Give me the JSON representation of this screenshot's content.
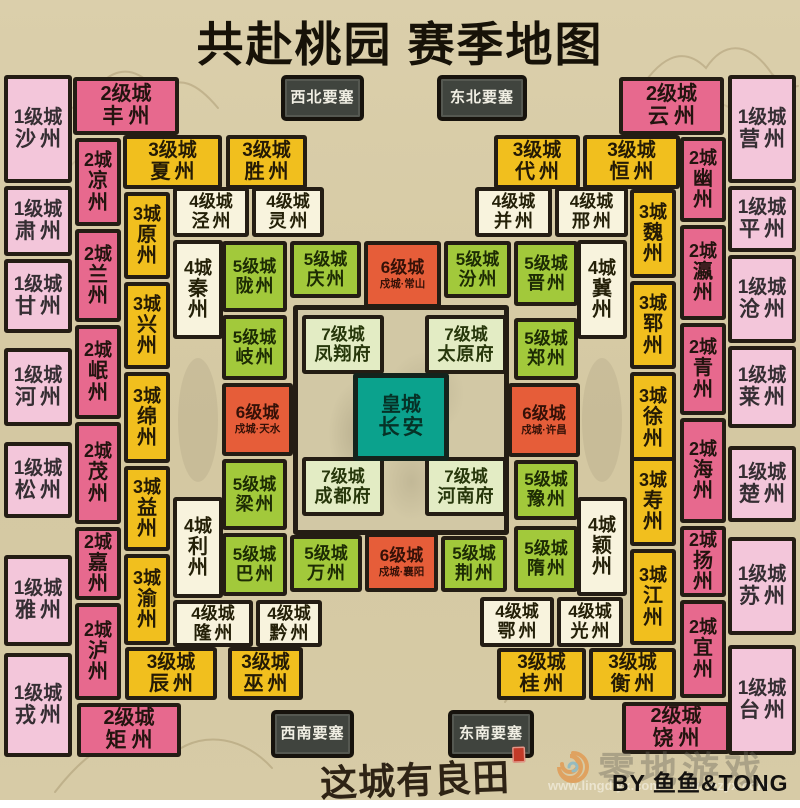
{
  "title": "共赴桃园 赛季地图",
  "logo": "这城有良田",
  "credit": "BY 鱼鱼&TONG",
  "watermark": {
    "brand": "零地游戏",
    "url1": "www.lingdiyx.com",
    "url2": "w.oezyx.com"
  },
  "palette": {
    "lv1": {
      "bg": "#f3c6da",
      "fg": "#352e33"
    },
    "lv2": {
      "bg": "#e7698e",
      "fg": "#23140f"
    },
    "lv3": {
      "bg": "#f1bf1e",
      "fg": "#241a05"
    },
    "lv4": {
      "bg": "#f8f3dd",
      "fg": "#242008"
    },
    "lv5": {
      "bg": "#a2c93b",
      "fg": "#1d2b04"
    },
    "lv6": {
      "bg": "#e65d39",
      "fg": "#351107"
    },
    "lv7": {
      "bg": "#e3ecc4",
      "fg": "#27370b"
    },
    "royal": {
      "bg": "#0ba28d",
      "fg": "#063227"
    },
    "fort": {
      "bg": "#40443e",
      "fg": "#f1efe4"
    }
  },
  "fortresses": [
    {
      "name": "西北要塞",
      "x": 281,
      "y": 75,
      "w": 83,
      "h": 46
    },
    {
      "name": "东北要塞",
      "x": 437,
      "y": 75,
      "w": 90,
      "h": 46
    },
    {
      "name": "西南要塞",
      "x": 271,
      "y": 710,
      "w": 83,
      "h": 48
    },
    {
      "name": "东南要塞",
      "x": 448,
      "y": 710,
      "w": 86,
      "h": 48
    }
  ],
  "center": {
    "box": {
      "x": 293,
      "y": 305,
      "w": 216,
      "h": 230
    },
    "palaces": [
      {
        "label": "7级城",
        "name": "凤翔府",
        "x": 302,
        "y": 315,
        "w": 82,
        "h": 59
      },
      {
        "label": "7级城",
        "name": "太原府",
        "x": 425,
        "y": 315,
        "w": 82,
        "h": 59
      },
      {
        "label": "7级城",
        "name": "成都府",
        "x": 302,
        "y": 457,
        "w": 82,
        "h": 59
      },
      {
        "label": "7级城",
        "name": "河南府",
        "x": 425,
        "y": 457,
        "w": 82,
        "h": 59
      }
    ],
    "imperial": {
      "label": "皇城",
      "name": "长安",
      "x": 353,
      "y": 373,
      "w": 96,
      "h": 88
    }
  },
  "tiles": [
    {
      "lv": "lv1",
      "label": "1级城",
      "name": "沙州",
      "o": "h",
      "x": 4,
      "y": 75,
      "w": 68,
      "h": 108
    },
    {
      "lv": "lv1",
      "label": "1级城",
      "name": "肃州",
      "o": "h",
      "x": 4,
      "y": 186,
      "w": 68,
      "h": 70
    },
    {
      "lv": "lv1",
      "label": "1级城",
      "name": "甘州",
      "o": "h",
      "x": 4,
      "y": 259,
      "w": 68,
      "h": 74
    },
    {
      "lv": "lv1",
      "label": "1级城",
      "name": "河州",
      "o": "h",
      "x": 4,
      "y": 348,
      "w": 68,
      "h": 78
    },
    {
      "lv": "lv1",
      "label": "1级城",
      "name": "松州",
      "o": "h",
      "x": 4,
      "y": 442,
      "w": 68,
      "h": 76
    },
    {
      "lv": "lv1",
      "label": "1级城",
      "name": "雅州",
      "o": "h",
      "x": 4,
      "y": 555,
      "w": 68,
      "h": 91
    },
    {
      "lv": "lv1",
      "label": "1级城",
      "name": "戎州",
      "o": "h",
      "x": 4,
      "y": 653,
      "w": 68,
      "h": 104
    },
    {
      "lv": "lv2",
      "label": "2级城",
      "name": "丰州",
      "o": "h",
      "x": 73,
      "y": 77,
      "w": 106,
      "h": 58
    },
    {
      "lv": "lv2",
      "label": "2城",
      "name": "凉州",
      "o": "v",
      "x": 75,
      "y": 138,
      "w": 46,
      "h": 88
    },
    {
      "lv": "lv2",
      "label": "2城",
      "name": "兰州",
      "o": "v",
      "x": 75,
      "y": 229,
      "w": 46,
      "h": 93
    },
    {
      "lv": "lv2",
      "label": "2城",
      "name": "岷州",
      "o": "v",
      "x": 75,
      "y": 325,
      "w": 46,
      "h": 94
    },
    {
      "lv": "lv2",
      "label": "2城",
      "name": "茂州",
      "o": "v",
      "x": 75,
      "y": 422,
      "w": 46,
      "h": 102
    },
    {
      "lv": "lv2",
      "label": "2城",
      "name": "嘉州",
      "o": "v",
      "x": 75,
      "y": 527,
      "w": 46,
      "h": 73
    },
    {
      "lv": "lv2",
      "label": "2城",
      "name": "泸州",
      "o": "v",
      "x": 75,
      "y": 603,
      "w": 46,
      "h": 97
    },
    {
      "lv": "lv2",
      "label": "2级城",
      "name": "矩州",
      "o": "h",
      "x": 77,
      "y": 703,
      "w": 104,
      "h": 54
    },
    {
      "lv": "lv3",
      "label": "3级城",
      "name": "夏州",
      "o": "h",
      "x": 123,
      "y": 135,
      "w": 99,
      "h": 54
    },
    {
      "lv": "lv3",
      "label": "3级城",
      "name": "胜州",
      "o": "h",
      "x": 226,
      "y": 135,
      "w": 81,
      "h": 54
    },
    {
      "lv": "lv3",
      "label": "3城",
      "name": "原州",
      "o": "v",
      "x": 124,
      "y": 192,
      "w": 46,
      "h": 87
    },
    {
      "lv": "lv3",
      "label": "3城",
      "name": "兴州",
      "o": "v",
      "x": 124,
      "y": 282,
      "w": 46,
      "h": 87
    },
    {
      "lv": "lv3",
      "label": "3城",
      "name": "绵州",
      "o": "v",
      "x": 124,
      "y": 372,
      "w": 46,
      "h": 91
    },
    {
      "lv": "lv3",
      "label": "3城",
      "name": "益州",
      "o": "v",
      "x": 124,
      "y": 466,
      "w": 46,
      "h": 85
    },
    {
      "lv": "lv3",
      "label": "3城",
      "name": "渝州",
      "o": "v",
      "x": 124,
      "y": 554,
      "w": 46,
      "h": 91
    },
    {
      "lv": "lv3",
      "label": "3级城",
      "name": "辰州",
      "o": "h",
      "x": 125,
      "y": 647,
      "w": 92,
      "h": 53
    },
    {
      "lv": "lv3",
      "label": "3级城",
      "name": "巫州",
      "o": "h",
      "x": 228,
      "y": 647,
      "w": 75,
      "h": 53
    },
    {
      "lv": "lv4",
      "label": "4级城",
      "name": "泾州",
      "o": "h",
      "x": 173,
      "y": 187,
      "w": 76,
      "h": 50
    },
    {
      "lv": "lv4",
      "label": "4级城",
      "name": "灵州",
      "o": "h",
      "x": 252,
      "y": 187,
      "w": 72,
      "h": 50
    },
    {
      "lv": "lv4",
      "label": "4城",
      "name": "秦州",
      "o": "v",
      "x": 173,
      "y": 240,
      "w": 50,
      "h": 99
    },
    {
      "lv": "lv4",
      "label": "4城",
      "name": "利州",
      "o": "v",
      "x": 173,
      "y": 497,
      "w": 50,
      "h": 101
    },
    {
      "lv": "lv4",
      "label": "4级城",
      "name": "隆州",
      "o": "h",
      "x": 173,
      "y": 600,
      "w": 80,
      "h": 47
    },
    {
      "lv": "lv4",
      "label": "4级城",
      "name": "黔州",
      "o": "h",
      "x": 256,
      "y": 600,
      "w": 66,
      "h": 47
    },
    {
      "lv": "lv5",
      "label": "5级城",
      "name": "陇州",
      "o": "h",
      "x": 222,
      "y": 241,
      "w": 65,
      "h": 71
    },
    {
      "lv": "lv5",
      "label": "5级城",
      "name": "岐州",
      "o": "h",
      "x": 222,
      "y": 315,
      "w": 65,
      "h": 65
    },
    {
      "lv": "lv6",
      "label": "6级城",
      "name": "天水",
      "sub": "戍城·天水",
      "o": "h",
      "x": 222,
      "y": 383,
      "w": 71,
      "h": 73
    },
    {
      "lv": "lv5",
      "label": "5级城",
      "name": "梁州",
      "o": "h",
      "x": 222,
      "y": 459,
      "w": 65,
      "h": 71
    },
    {
      "lv": "lv5",
      "label": "5级城",
      "name": "巴州",
      "o": "h",
      "x": 222,
      "y": 533,
      "w": 65,
      "h": 63
    },
    {
      "lv": "lv5",
      "label": "5级城",
      "name": "庆州",
      "o": "h",
      "x": 290,
      "y": 241,
      "w": 71,
      "h": 57
    },
    {
      "lv": "lv6",
      "label": "6级城",
      "name": "常山",
      "sub": "戍城·常山",
      "o": "h",
      "x": 364,
      "y": 241,
      "w": 77,
      "h": 67
    },
    {
      "lv": "lv5",
      "label": "5级城",
      "name": "汾州",
      "o": "h",
      "x": 444,
      "y": 241,
      "w": 67,
      "h": 57
    },
    {
      "lv": "lv5",
      "label": "5级城",
      "name": "晋州",
      "o": "h",
      "x": 514,
      "y": 241,
      "w": 64,
      "h": 65
    },
    {
      "lv": "lv5",
      "label": "5级城",
      "name": "郑州",
      "o": "h",
      "x": 514,
      "y": 318,
      "w": 64,
      "h": 62
    },
    {
      "lv": "lv6",
      "label": "6级城",
      "name": "许昌",
      "sub": "戍城·许昌",
      "o": "h",
      "x": 508,
      "y": 383,
      "w": 72,
      "h": 74
    },
    {
      "lv": "lv5",
      "label": "5级城",
      "name": "豫州",
      "o": "h",
      "x": 514,
      "y": 460,
      "w": 64,
      "h": 60
    },
    {
      "lv": "lv5",
      "label": "5级城",
      "name": "隋州",
      "o": "h",
      "x": 514,
      "y": 526,
      "w": 64,
      "h": 66
    },
    {
      "lv": "lv5",
      "label": "5级城",
      "name": "万州",
      "o": "h",
      "x": 290,
      "y": 535,
      "w": 72,
      "h": 57
    },
    {
      "lv": "lv6",
      "label": "6级城",
      "name": "襄阳",
      "sub": "戍城·襄阳",
      "o": "h",
      "x": 365,
      "y": 533,
      "w": 73,
      "h": 59
    },
    {
      "lv": "lv5",
      "label": "5级城",
      "name": "荆州",
      "o": "h",
      "x": 441,
      "y": 536,
      "w": 66,
      "h": 56
    },
    {
      "lv": "lv4",
      "label": "4级城",
      "name": "并州",
      "o": "h",
      "x": 475,
      "y": 187,
      "w": 77,
      "h": 50
    },
    {
      "lv": "lv4",
      "label": "4级城",
      "name": "邢州",
      "o": "h",
      "x": 555,
      "y": 187,
      "w": 73,
      "h": 50
    },
    {
      "lv": "lv4",
      "label": "4城",
      "name": "冀州",
      "o": "v",
      "x": 577,
      "y": 240,
      "w": 50,
      "h": 99
    },
    {
      "lv": "lv4",
      "label": "4城",
      "name": "颖州",
      "o": "v",
      "x": 577,
      "y": 497,
      "w": 50,
      "h": 99
    },
    {
      "lv": "lv4",
      "label": "4级城",
      "name": "鄂州",
      "o": "h",
      "x": 480,
      "y": 597,
      "w": 74,
      "h": 50
    },
    {
      "lv": "lv4",
      "label": "4级城",
      "name": "光州",
      "o": "h",
      "x": 557,
      "y": 597,
      "w": 66,
      "h": 50
    },
    {
      "lv": "lv3",
      "label": "3级城",
      "name": "代州",
      "o": "h",
      "x": 494,
      "y": 135,
      "w": 86,
      "h": 54
    },
    {
      "lv": "lv3",
      "label": "3级城",
      "name": "恒州",
      "o": "h",
      "x": 583,
      "y": 135,
      "w": 97,
      "h": 54
    },
    {
      "lv": "lv3",
      "label": "3城",
      "name": "魏州",
      "o": "v",
      "x": 630,
      "y": 189,
      "w": 46,
      "h": 89
    },
    {
      "lv": "lv3",
      "label": "3城",
      "name": "郓州",
      "o": "v",
      "x": 630,
      "y": 281,
      "w": 46,
      "h": 88
    },
    {
      "lv": "lv3",
      "label": "3城",
      "name": "徐州",
      "o": "v",
      "x": 630,
      "y": 372,
      "w": 46,
      "h": 92
    },
    {
      "lv": "lv3",
      "label": "3城",
      "name": "寿州",
      "o": "v",
      "x": 630,
      "y": 457,
      "w": 46,
      "h": 89
    },
    {
      "lv": "lv3",
      "label": "3城",
      "name": "江州",
      "o": "v",
      "x": 630,
      "y": 549,
      "w": 46,
      "h": 96
    },
    {
      "lv": "lv3",
      "label": "3级城",
      "name": "桂州",
      "o": "h",
      "x": 497,
      "y": 648,
      "w": 89,
      "h": 52
    },
    {
      "lv": "lv3",
      "label": "3级城",
      "name": "衡州",
      "o": "h",
      "x": 589,
      "y": 648,
      "w": 87,
      "h": 52
    },
    {
      "lv": "lv2",
      "label": "2级城",
      "name": "云州",
      "o": "h",
      "x": 619,
      "y": 77,
      "w": 105,
      "h": 58
    },
    {
      "lv": "lv2",
      "label": "2城",
      "name": "幽州",
      "o": "v",
      "x": 680,
      "y": 137,
      "w": 46,
      "h": 85
    },
    {
      "lv": "lv2",
      "label": "2城",
      "name": "瀛州",
      "o": "v",
      "x": 680,
      "y": 225,
      "w": 46,
      "h": 95
    },
    {
      "lv": "lv2",
      "label": "2城",
      "name": "青州",
      "o": "v",
      "x": 680,
      "y": 323,
      "w": 46,
      "h": 92
    },
    {
      "lv": "lv2",
      "label": "2城",
      "name": "海州",
      "o": "v",
      "x": 680,
      "y": 418,
      "w": 46,
      "h": 105
    },
    {
      "lv": "lv2",
      "label": "2城",
      "name": "扬州",
      "o": "v",
      "x": 680,
      "y": 526,
      "w": 46,
      "h": 71
    },
    {
      "lv": "lv2",
      "label": "2城",
      "name": "宜州",
      "o": "v",
      "x": 680,
      "y": 600,
      "w": 46,
      "h": 98
    },
    {
      "lv": "lv2",
      "label": "2级城",
      "name": "饶州",
      "o": "h",
      "x": 622,
      "y": 702,
      "w": 108,
      "h": 52
    },
    {
      "lv": "lv1",
      "label": "1级城",
      "name": "营州",
      "o": "h",
      "x": 728,
      "y": 75,
      "w": 68,
      "h": 108
    },
    {
      "lv": "lv1",
      "label": "1级城",
      "name": "平州",
      "o": "h",
      "x": 728,
      "y": 186,
      "w": 68,
      "h": 66
    },
    {
      "lv": "lv1",
      "label": "1级城",
      "name": "沧州",
      "o": "h",
      "x": 728,
      "y": 255,
      "w": 68,
      "h": 88
    },
    {
      "lv": "lv1",
      "label": "1级城",
      "name": "莱州",
      "o": "h",
      "x": 728,
      "y": 346,
      "w": 68,
      "h": 82
    },
    {
      "lv": "lv1",
      "label": "1级城",
      "name": "楚州",
      "o": "h",
      "x": 728,
      "y": 446,
      "w": 68,
      "h": 76
    },
    {
      "lv": "lv1",
      "label": "1级城",
      "name": "苏州",
      "o": "h",
      "x": 728,
      "y": 537,
      "w": 68,
      "h": 98
    },
    {
      "lv": "lv1",
      "label": "1级城",
      "name": "台州",
      "o": "h",
      "x": 728,
      "y": 645,
      "w": 68,
      "h": 110
    }
  ]
}
